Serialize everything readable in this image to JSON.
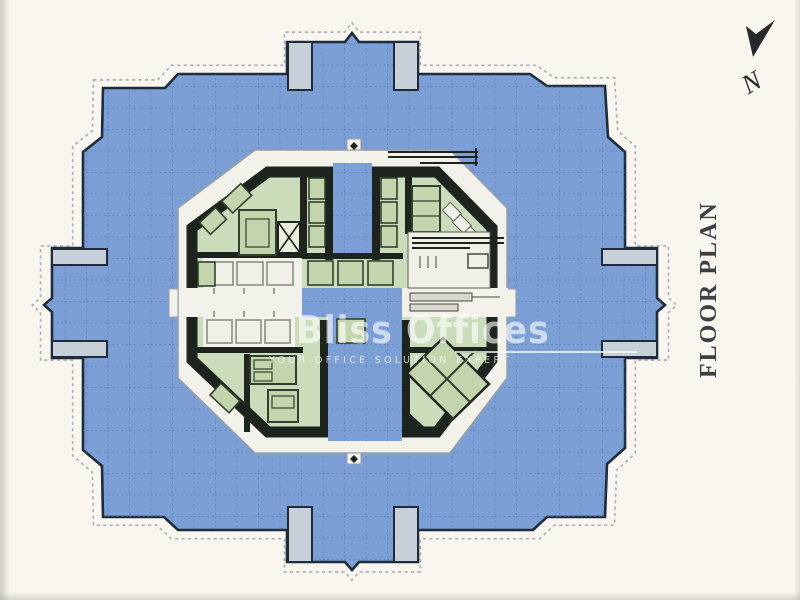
{
  "title": {
    "label": "FLOOR PLAN"
  },
  "compass": {
    "label": "N"
  },
  "watermark": {
    "brand": "Bliss Offices",
    "tagline": "YOUR OFFICE SOLUTION EXPERT"
  },
  "colors": {
    "background": "#f8f6ee",
    "floor_blue": "#7ca0d5",
    "grid_blue": "#4f73b4",
    "outline_navy": "#1d2b3a",
    "pier_gray": "#c7cfd8",
    "core_ring_white": "#f3f2ea",
    "core_wall_dark": "#1c241d",
    "room_green": "#cbdcba",
    "room_green2": "#c2d5ac",
    "room_green_dark": "#31402e",
    "cell_white": "#f1f0e8",
    "dashed_gray": "#aab0b8",
    "label_gray": "#3c4044"
  }
}
